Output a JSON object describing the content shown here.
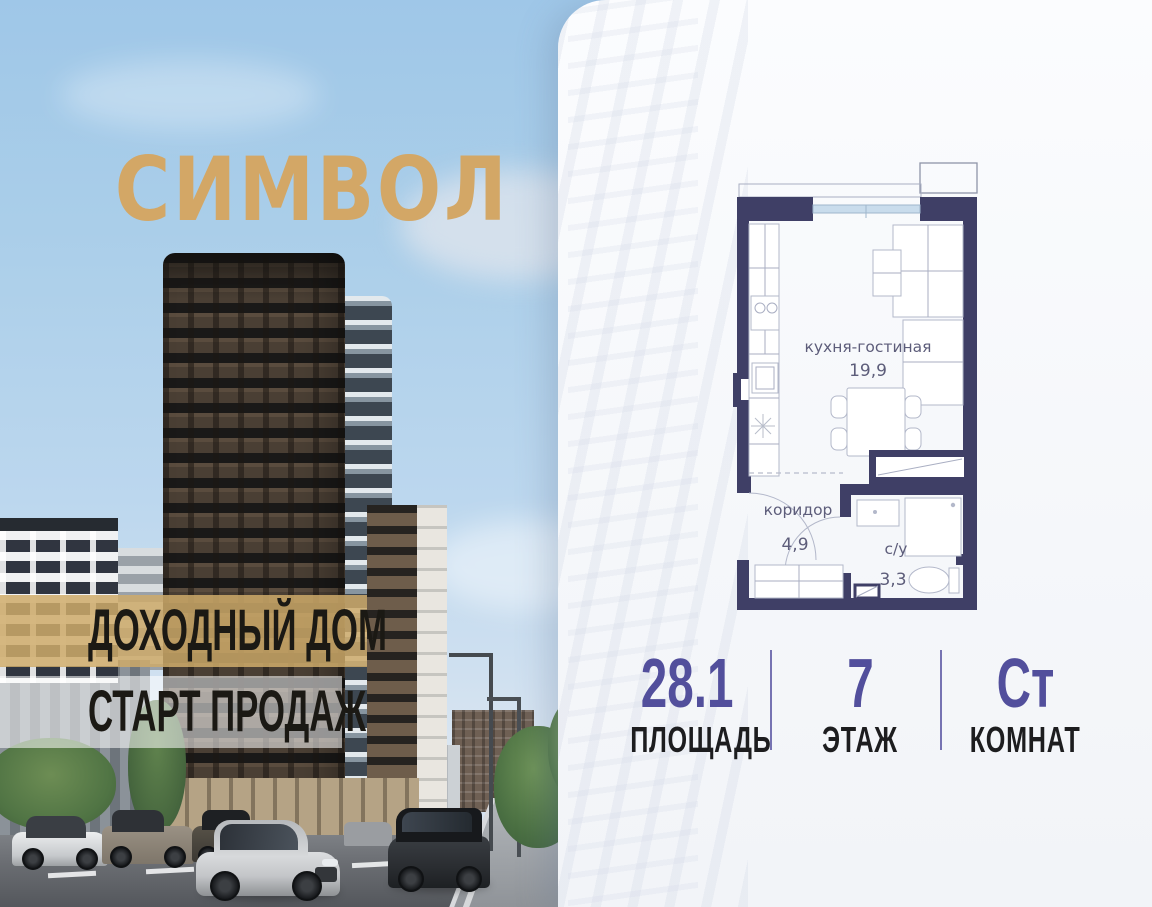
{
  "brand": {
    "logo": "СИМВОЛ",
    "logo_color": "#d3a766"
  },
  "banners": {
    "line1": "ДОХОДНЫЙ ДОМ",
    "line2": "СТАРТ ПРОДАЖ"
  },
  "floorplan": {
    "rooms": [
      {
        "name": "кухня-гостиная",
        "area": "19,9"
      },
      {
        "name": "коридор",
        "area": "4,9"
      },
      {
        "name": "с/у",
        "area": "3,3"
      }
    ],
    "colors": {
      "wall": "#3f3f66",
      "window": "#c9dcec",
      "label": "#5d5d7a"
    }
  },
  "stats": {
    "value_color": "#524f9c",
    "items": [
      {
        "value": "28.1",
        "label": "ПЛОЩАДЬ"
      },
      {
        "value": "7",
        "label": "ЭТАЖ"
      },
      {
        "value": "Ст",
        "label": "КОМНАТ"
      }
    ]
  }
}
